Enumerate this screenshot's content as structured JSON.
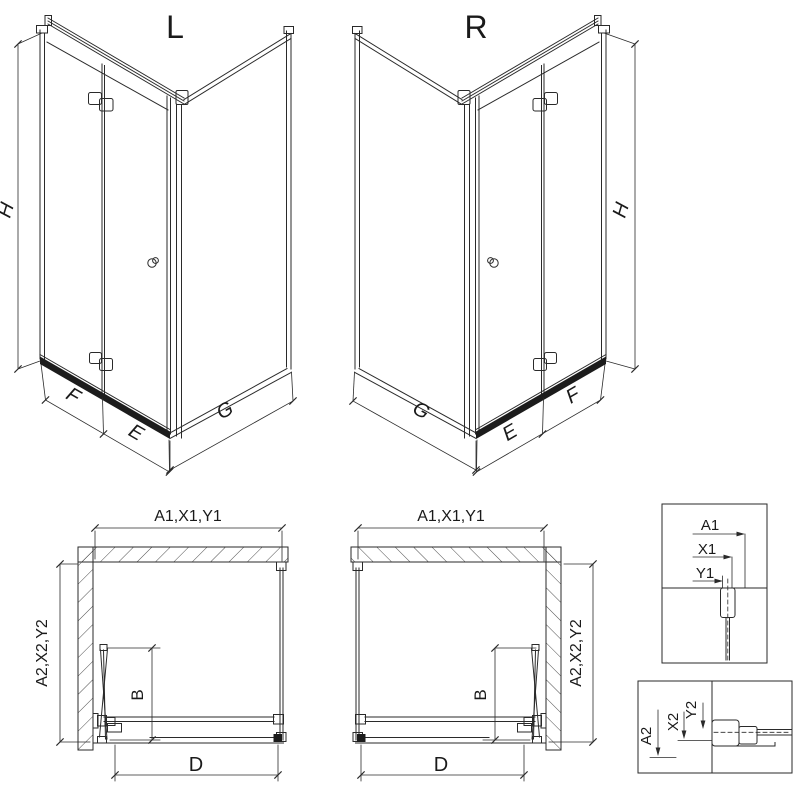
{
  "colors": {
    "line": "#2a2a2a",
    "dark": "#1c1c1c",
    "background": "#ffffff"
  },
  "views": {
    "left": {
      "label": "L",
      "height_dim": "H",
      "fold_panel_dim": "F",
      "door_dim": "E",
      "side_panel_dim": "G"
    },
    "right": {
      "label": "R",
      "height_dim": "H",
      "fold_panel_dim": "F",
      "door_dim": "E",
      "side_panel_dim": "G"
    }
  },
  "plans": {
    "left": {
      "top_dim": "A1,X1,Y1",
      "side_dim": "A2,X2,Y2",
      "fold_depth_dim": "B",
      "opening_dim": "D"
    },
    "right": {
      "top_dim": "A1,X1,Y1",
      "side_dim": "A2,X2,Y2",
      "fold_depth_dim": "B",
      "opening_dim": "D"
    }
  },
  "details": {
    "top": {
      "dim_a": "A1",
      "dim_x": "X1",
      "dim_y": "Y1"
    },
    "bottom": {
      "dim_a": "A2",
      "dim_x": "X2",
      "dim_y": "Y2"
    }
  }
}
